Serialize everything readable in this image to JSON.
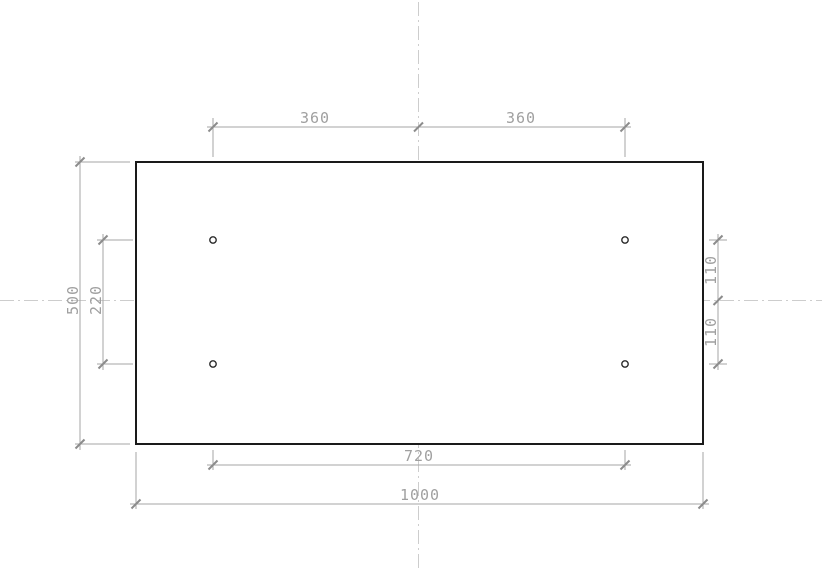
{
  "drawing": {
    "description": "2D engineering drawing: rectangular plate with four small holes, centerlines and linear dimensions with oblique tick marks",
    "colors": {
      "outline": "#1a1a1a",
      "dimension_line": "#a6a6a6",
      "tick": "#8c8c8c",
      "text": "#a0a0a0",
      "centerline": "#cdcdcd",
      "background": "#ffffff"
    },
    "labels": {
      "top_span_left": "360",
      "top_span_right": "360",
      "left_overall_height": "500",
      "left_hole_spacing": "220",
      "right_upper_offset": "110",
      "right_lower_offset": "110",
      "bottom_hole_spacing": "720",
      "bottom_overall_width": "1000"
    }
  }
}
